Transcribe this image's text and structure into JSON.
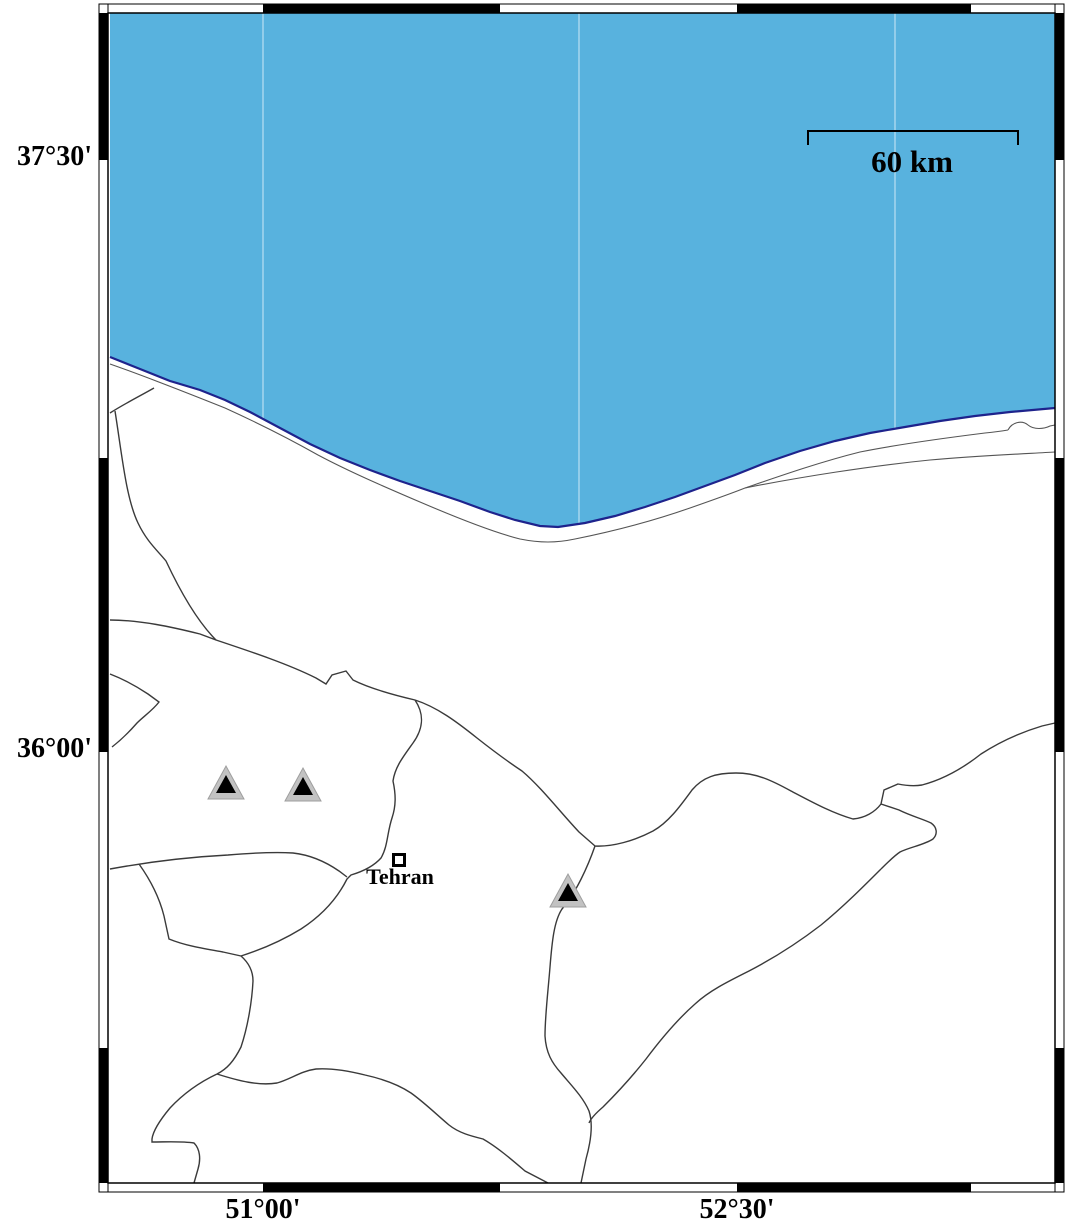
{
  "map": {
    "title": "Tehran region / southern Caspian Sea coast map",
    "axis_labels": {
      "left": [
        {
          "text": "37°30'",
          "y": 160
        },
        {
          "text": "36°00'",
          "y": 752
        }
      ],
      "bottom": [
        {
          "text": "51°00'",
          "x": 263
        },
        {
          "text": "52°30'",
          "x": 737
        }
      ]
    },
    "scale_bar": {
      "label": "60 km",
      "x1": 808,
      "x2": 1018,
      "y": 131,
      "tick_drop": 14,
      "label_cx": 912,
      "label_top": 144
    },
    "city": {
      "name": "Tehran",
      "x": 399,
      "y": 860,
      "label_cx": 400,
      "label_top": 864
    },
    "volcano_markers": [
      {
        "x": 226,
        "y": 799
      },
      {
        "x": 303,
        "y": 801
      },
      {
        "x": 568,
        "y": 907
      }
    ],
    "gridline_x": [
      263,
      579,
      895
    ],
    "colors": {
      "sea": "#58b2de",
      "coast_outline": "#1e238c",
      "boundary": "#3a3a3a",
      "coastline_thin": "#555555",
      "volcano_gray": "#c2c2c2",
      "frame": "#000000",
      "gridline": "rgba(255,255,255,0.5)"
    }
  }
}
